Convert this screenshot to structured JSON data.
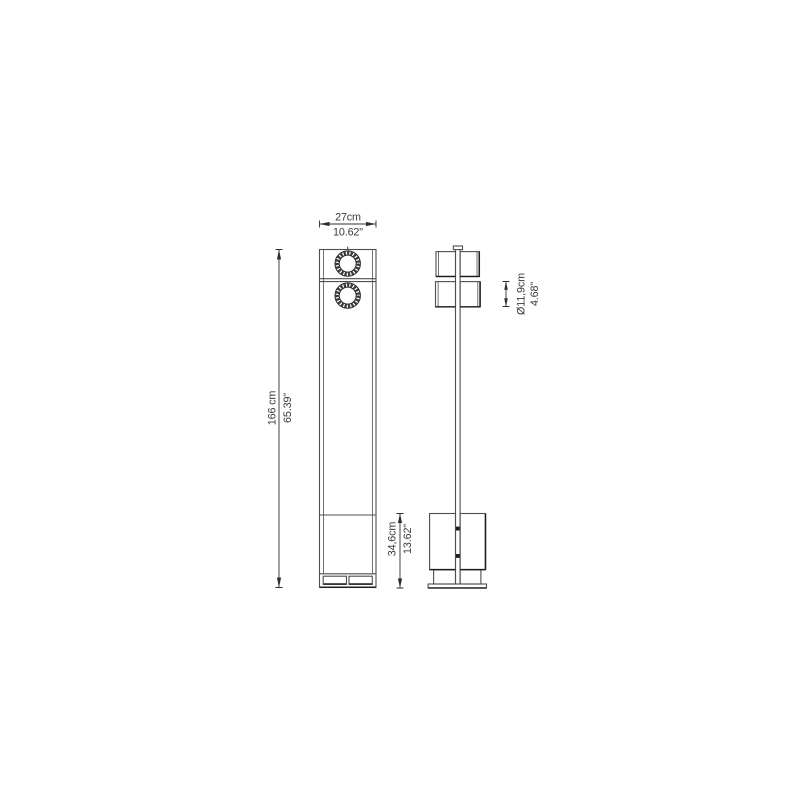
{
  "drawing": {
    "dimensions": {
      "width": {
        "cm": "27cm",
        "inches": "10.62\""
      },
      "total_height": {
        "cm": "166 cm",
        "inches": "65.39\""
      },
      "base_height": {
        "cm": "34,6cm",
        "inches": "13.62\""
      },
      "spot_diameter": {
        "cm": "Ø11,9cm",
        "inches": "4.68\""
      }
    },
    "colors": {
      "background": "#ffffff",
      "line": "#4f4f4f",
      "accent": "#1c1c1c",
      "dimension_line": "#2f2f2f",
      "text": "#3a3a3a"
    }
  }
}
